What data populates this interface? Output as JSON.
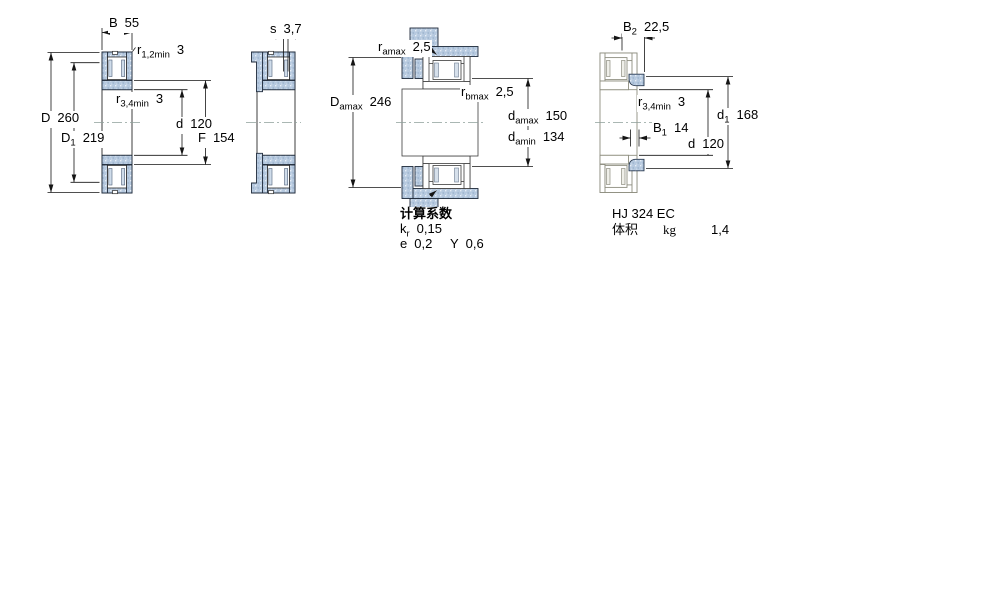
{
  "page": {
    "background": "#ffffff"
  },
  "colors": {
    "steel_fill": "#b6c9df",
    "steel_stroke": "#1f2a3a",
    "outline_gray": "#8d8d7f",
    "dim_line": "#151515",
    "centerline": "#8fa09b"
  },
  "figures": {
    "fig1": {
      "name": "bearing cross-section",
      "labels": {
        "B": {
          "sym": "B",
          "sub": "",
          "val": "55"
        },
        "r12min": {
          "sym": "r",
          "sub": "1,2min",
          "val": "3"
        },
        "r34min": {
          "sym": "r",
          "sub": "3,4min",
          "val": "3"
        },
        "D": {
          "sym": "D",
          "sub": "",
          "val": "260"
        },
        "D1": {
          "sym": "D",
          "sub": "1",
          "val": "219"
        },
        "d": {
          "sym": "d",
          "sub": "",
          "val": "120"
        },
        "F": {
          "sym": "F",
          "sub": "",
          "val": "154"
        }
      }
    },
    "fig2": {
      "name": "bearing with HJ ring cross-section",
      "labels": {
        "s": {
          "sym": "s",
          "sub": "",
          "val": "3,7"
        }
      }
    },
    "fig3": {
      "name": "mounting dimensions",
      "labels": {
        "ramax": {
          "sym": "r",
          "sub": "amax",
          "val": "2,5"
        },
        "Damax": {
          "sym": "D",
          "sub": "amax",
          "val": "246"
        },
        "rbmax": {
          "sym": "r",
          "sub": "bmax",
          "val": "2,5"
        },
        "damax": {
          "sym": "d",
          "sub": "amax",
          "val": "150"
        },
        "damin": {
          "sym": "d",
          "sub": "amin",
          "val": "134"
        }
      },
      "calculation_factors": {
        "header": "计算系数",
        "kr": {
          "sym": "k",
          "sub": "r",
          "val": "0,15"
        },
        "e": {
          "sym": "e",
          "sub": "",
          "val": "0,2"
        },
        "Y": {
          "sym": "Y",
          "sub": "",
          "val": "0,6"
        }
      }
    },
    "fig4": {
      "name": "HJ angle ring dimensions",
      "labels": {
        "B2": {
          "sym": "B",
          "sub": "2",
          "val": "22,5"
        },
        "r34min": {
          "sym": "r",
          "sub": "3,4min",
          "val": "3"
        },
        "B1": {
          "sym": "B",
          "sub": "1",
          "val": "14"
        },
        "d1": {
          "sym": "d",
          "sub": "1",
          "val": "168"
        },
        "d": {
          "sym": "d",
          "sub": "",
          "val": "120"
        }
      },
      "info": {
        "designation": "HJ 324 EC",
        "mass_label": "体积",
        "mass_unit": "kg",
        "mass_value": "1,4"
      }
    }
  }
}
